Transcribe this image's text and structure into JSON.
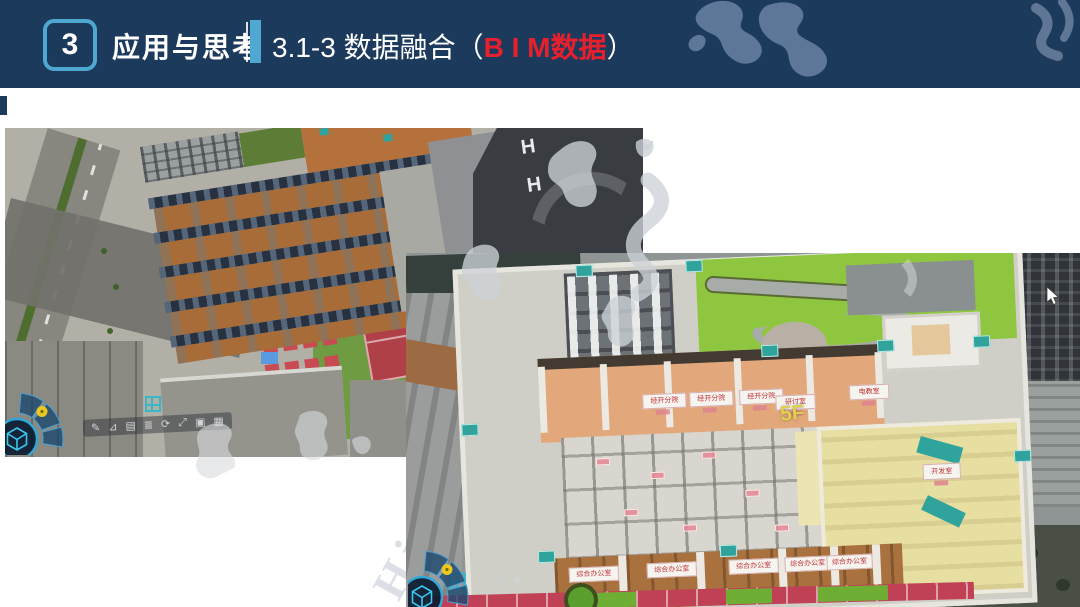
{
  "header": {
    "section_number": "3",
    "section_title": "应用与思考",
    "subtitle_prefix": "3.1-3 数据融合（",
    "subtitle_highlight": "B I M数据",
    "subtitle_suffix": "）"
  },
  "watermark": {
    "text": "High-level Laborat"
  },
  "colors": {
    "header_bg": "#1c3a5c",
    "accent_blue": "#4fa8d2",
    "subtitle_red": "#e8202e",
    "floor_label_yellow": "#e2cf4a",
    "room_sign_red": "#c03038",
    "teal_accent": "#2fa39c",
    "lawn_green": "#8ec73f"
  },
  "left_viewer": {
    "helipads": [
      "H",
      "H"
    ],
    "toolbar_icons": [
      {
        "name": "pen-tool-icon",
        "glyph": "✎"
      },
      {
        "name": "measure-tool-icon",
        "glyph": "⊿"
      },
      {
        "name": "layers-tool-icon",
        "glyph": "▤"
      },
      {
        "name": "list-tool-icon",
        "glyph": "≣"
      },
      {
        "name": "refresh-tool-icon",
        "glyph": "⟳"
      },
      {
        "name": "expand-tool-icon",
        "glyph": "⤢"
      },
      {
        "name": "frame-tool-icon",
        "glyph": "▣"
      },
      {
        "name": "grid-tool-icon",
        "glyph": "▦"
      }
    ]
  },
  "right_viewer": {
    "floor_label": "5F",
    "rooms_top": [
      "经开分院",
      "经开分院",
      "经开分院",
      "研讨室",
      "电教室"
    ],
    "open_office_label": "开发室",
    "rooms_bottom": [
      "综合办公室",
      "综合办公室",
      "综合办公室",
      "综合办公室",
      "综合办公室"
    ],
    "toolbar_icons": [
      {
        "name": "pen-tool-icon",
        "glyph": "✎"
      },
      {
        "name": "mountain-tool-icon",
        "glyph": "▲"
      }
    ]
  }
}
